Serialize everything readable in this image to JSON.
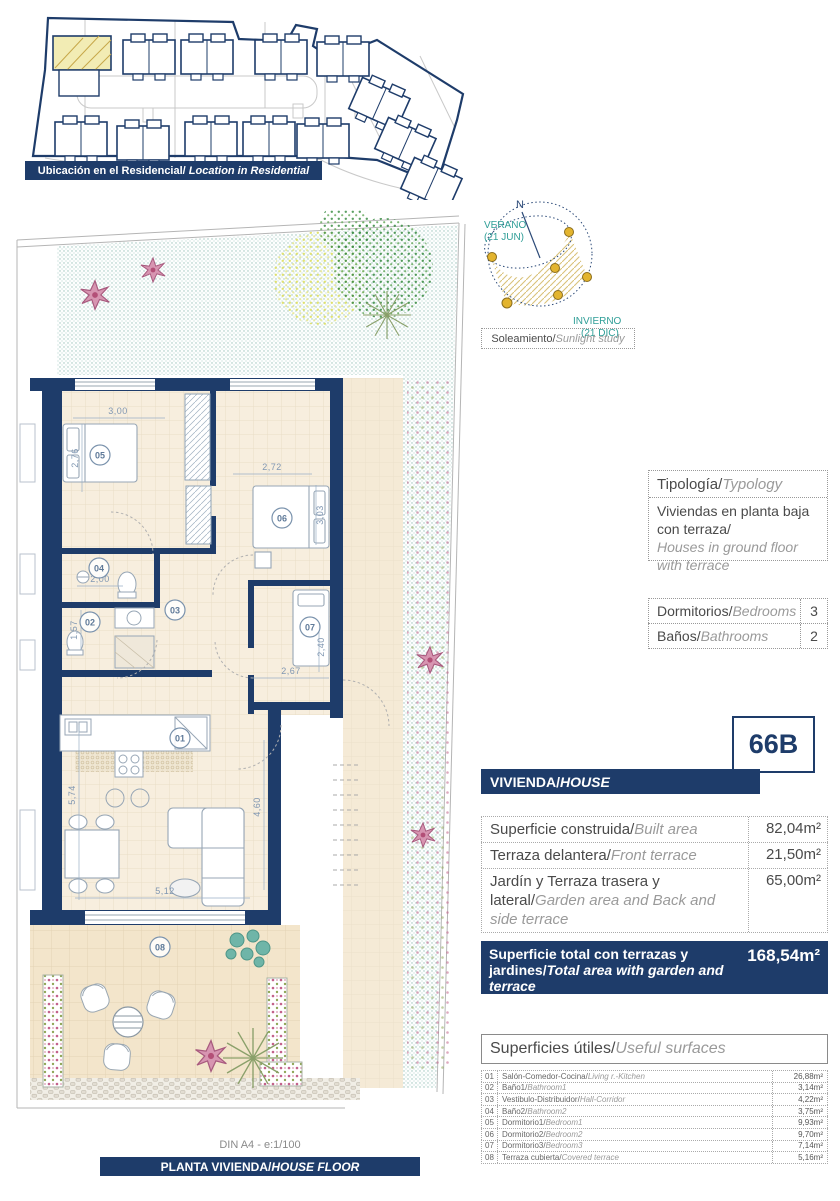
{
  "colors": {
    "navy": "#1e3c6a",
    "teal_label": "#2f9e97",
    "sun_gold": "#e3b42e",
    "garden_green": "#4a9a4a",
    "flower_pink": "#c2628a",
    "dim_blue": "#8097b2"
  },
  "location_banner": {
    "es": "Ubicación en el Residencial/",
    "en": "Location in Residential"
  },
  "sun_study": {
    "north": "N",
    "summer_line1": "VERANO",
    "summer_line2": "(21 JUN)",
    "winter_line1": "INVIERNO",
    "winter_line2": "(21 DIC)",
    "caption_es": "Soleamiento/",
    "caption_en": "Sunlight study"
  },
  "typology": {
    "title_es": "Tipología/",
    "title_en": "Typology",
    "body_es": "Viviendas en planta baja con terraza/",
    "body_en": "Houses in ground floor with terrace"
  },
  "counts": {
    "rows": [
      {
        "label_es": "Dormitorios/",
        "label_en": "Bedrooms",
        "value": "3"
      },
      {
        "label_es": "Baños/",
        "label_en": "Bathrooms",
        "value": "2"
      }
    ]
  },
  "unit_code": "66B",
  "house_banner": {
    "es": "VIVIENDA/",
    "en": "HOUSE"
  },
  "areas": {
    "rows": [
      {
        "label_es": "Superficie construida/",
        "label_en": "Built area",
        "value": "82,04m²"
      },
      {
        "label_es": "Terraza delantera/",
        "label_en": "Front terrace",
        "value": "21,50m²"
      },
      {
        "label_es": "Jardín y Terraza trasera y lateral/",
        "label_en": "Garden area and Back and side terrace",
        "value": "65,00m²"
      }
    ]
  },
  "total": {
    "label_es": "Superficie total con terrazas y jardines/",
    "label_en": "Total area with garden and terrace",
    "value": "168,54m²"
  },
  "useful": {
    "header_es": "Superficies útiles/",
    "header_en": "Useful surfaces",
    "rows": [
      {
        "num": "01",
        "name_es": "Salón-Comedor-Cocina/",
        "name_en": "Living r.-Kitchen",
        "value": "26,88m²"
      },
      {
        "num": "02",
        "name_es": "Baño1/",
        "name_en": "Bathroom1",
        "value": "3,14m²"
      },
      {
        "num": "03",
        "name_es": "Vestibulo-Distribuidor/",
        "name_en": "Hall-Corridor",
        "value": "4,22m²"
      },
      {
        "num": "04",
        "name_es": "Baño2/",
        "name_en": "Bathroom2",
        "value": "3,75m²"
      },
      {
        "num": "05",
        "name_es": "Dormitorio1/",
        "name_en": "Bedroom1",
        "value": "9,93m²"
      },
      {
        "num": "06",
        "name_es": "Dormitorio2/",
        "name_en": "Bedroom2",
        "value": "9,70m²"
      },
      {
        "num": "07",
        "name_es": "Dormitorio3/",
        "name_en": "Bedroom3",
        "value": "7,14m²"
      },
      {
        "num": "08",
        "name_es": "Terraza cubierta/",
        "name_en": "Covered terrace",
        "value": "5,16m²"
      }
    ]
  },
  "floorplan": {
    "rooms": [
      {
        "num": "01"
      },
      {
        "num": "02"
      },
      {
        "num": "03"
      },
      {
        "num": "04"
      },
      {
        "num": "05"
      },
      {
        "num": "06"
      },
      {
        "num": "07"
      },
      {
        "num": "08"
      }
    ],
    "dims": [
      "3,00",
      "2,76",
      "2,72",
      "3,03",
      "2,00",
      "1,57",
      "2,67",
      "2,40",
      "5,74",
      "4,60",
      "5,12"
    ]
  },
  "footer": {
    "scale": "DIN A4 - e:1/100",
    "banner_es": "PLANTA VIVIENDA/",
    "banner_en": "HOUSE FLOOR"
  }
}
